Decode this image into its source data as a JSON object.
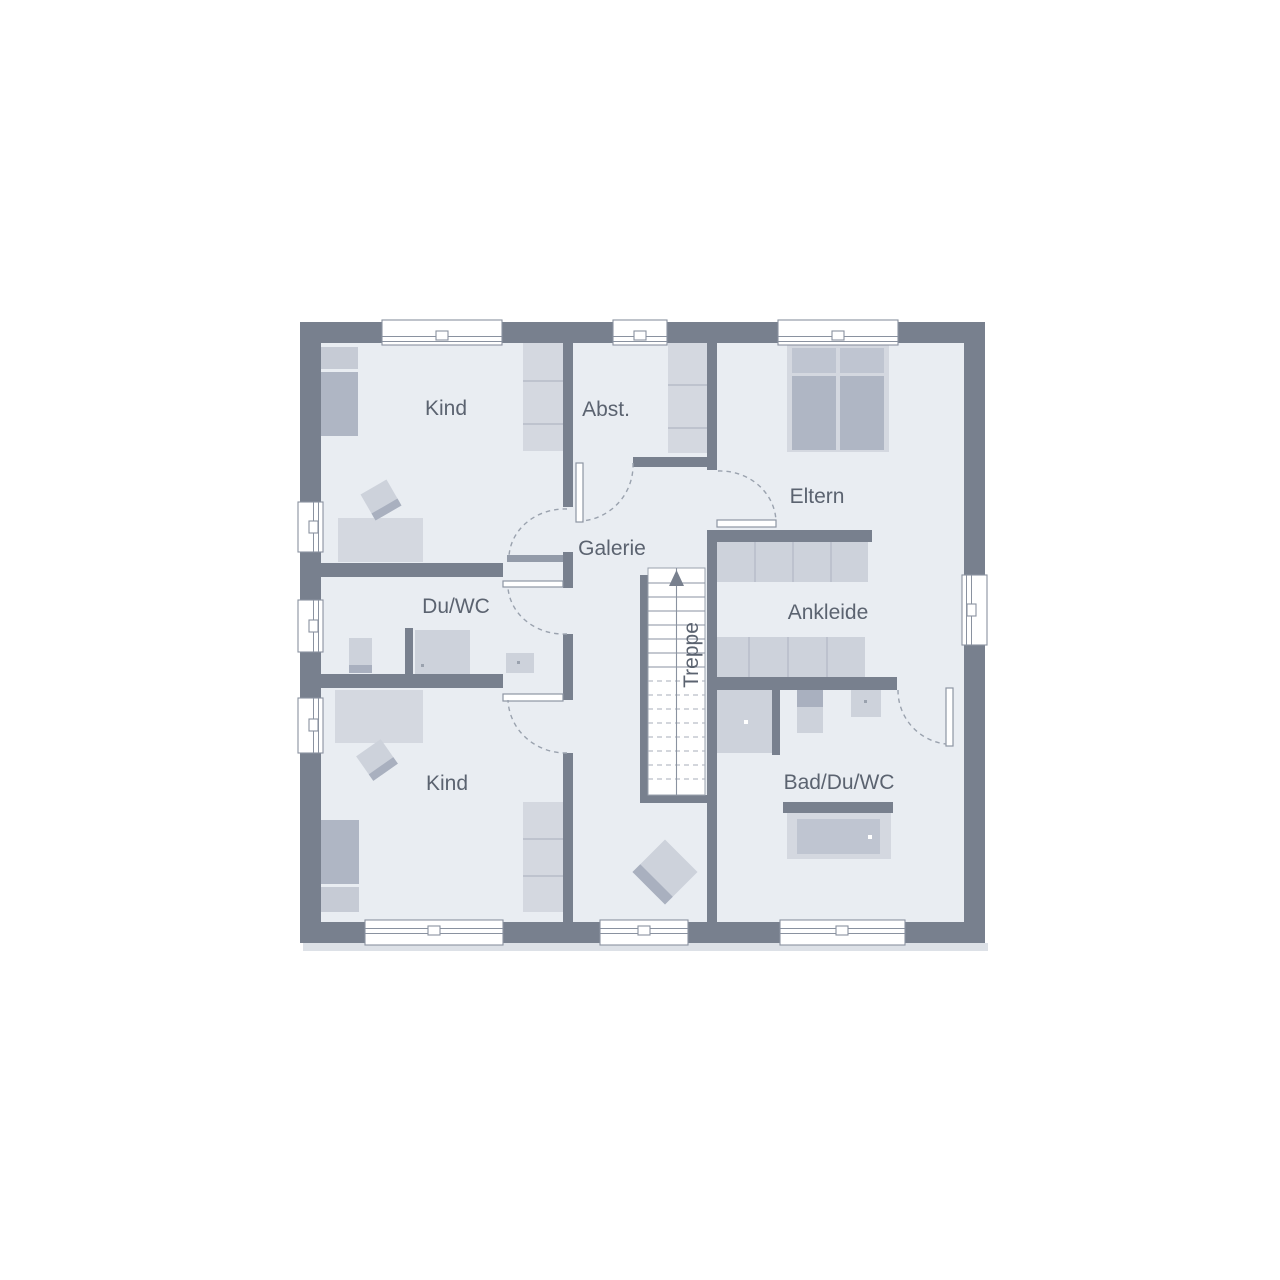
{
  "floorplan": {
    "title": "upper-floor-plan",
    "labels": {
      "kind_top": "Kind",
      "abst": "Abst.",
      "eltern": "Eltern",
      "galerie": "Galerie",
      "du_wc": "Du/WC",
      "ankleide": "Ankleide",
      "kind_bottom": "Kind",
      "bad_du_wc": "Bad/Du/WC",
      "treppe": "Treppe"
    },
    "colors": {
      "background": "#FFFFFF",
      "wall": "#78808E",
      "floor": "#E9EDF2",
      "furniture_light": "#D4D8E0",
      "furniture_wardrobe": "#CDD2DB",
      "furniture_mid": "#C6CBD5",
      "furniture_dark": "#AFB6C4",
      "furniture_accent": "#A9B0BF",
      "window_line": "#8A92A0",
      "door_arc": "#9AA2AE",
      "label_text": "#5B6370",
      "shadow": "#DDE1E7"
    }
  }
}
